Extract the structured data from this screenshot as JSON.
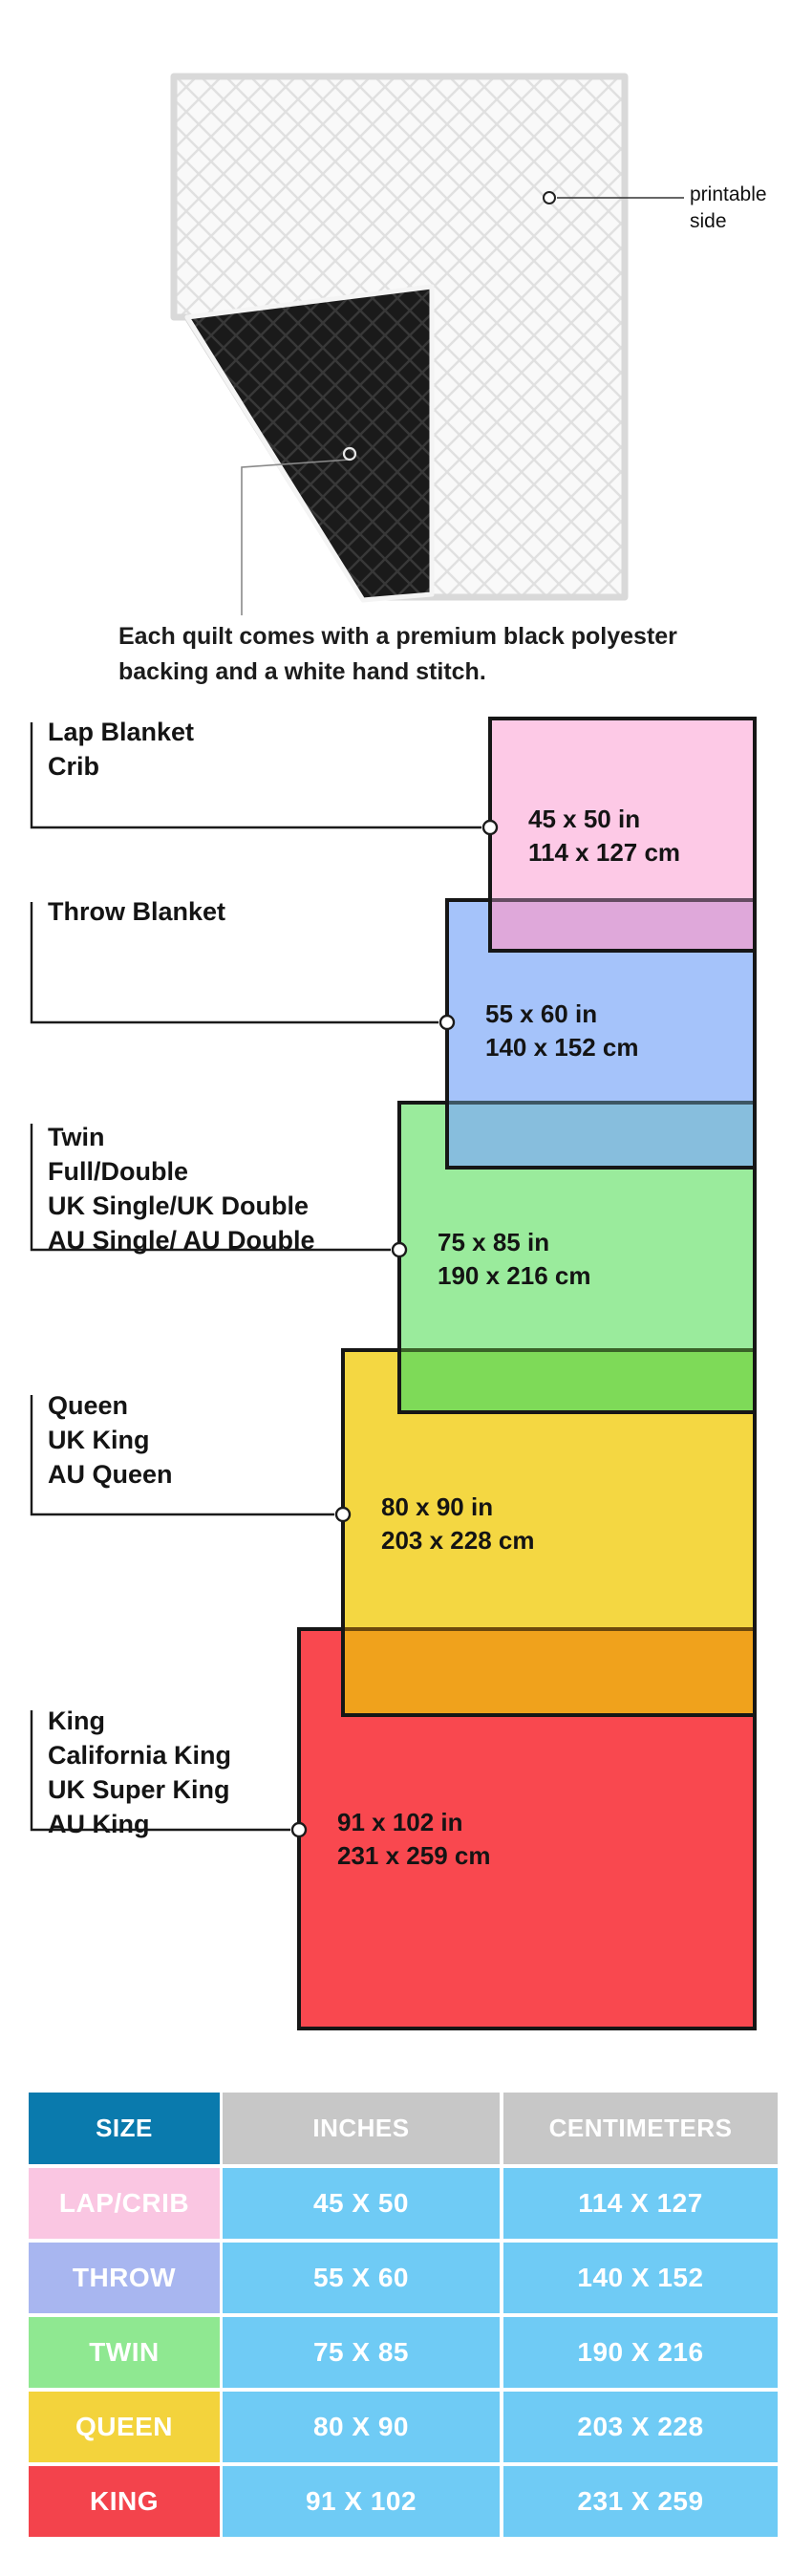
{
  "quilt": {
    "printable_label": "printable side",
    "caption_line1": "Each quilt comes with a premium black polyester",
    "caption_line2": "backing and a white hand stitch."
  },
  "sizes": [
    {
      "labels": [
        "Lap Blanket",
        "Crib"
      ],
      "inches": "45 x 50 in",
      "cm": "114 x 127 cm",
      "fill": "#fdc9e6",
      "overlap_fill": "#dfa8da"
    },
    {
      "labels": [
        "Throw Blanket"
      ],
      "inches": "55 x 60 in",
      "cm": "140 x 152 cm",
      "fill": "#a5c3fa",
      "overlap_fill": "#87bedd"
    },
    {
      "labels": [
        "Twin",
        "Full/Double",
        "UK Single/UK Double",
        "AU Single/ AU Double"
      ],
      "inches": "75 x 85 in",
      "cm": "190 x 216 cm",
      "fill": "#9aeb9c",
      "overlap_fill": "#7eda58"
    },
    {
      "labels": [
        "Queen",
        "UK King",
        "AU Queen"
      ],
      "inches": "80 x 90 in",
      "cm": "203 x 228 cm",
      "fill": "#f4d742",
      "overlap_fill": "#f0a21c"
    },
    {
      "labels": [
        "King",
        "California King",
        "UK Super King",
        "AU King"
      ],
      "inches": "91 x 102 in",
      "cm": "231 x 259 cm",
      "fill": "#f9484f",
      "overlap_fill": ""
    }
  ],
  "table": {
    "headers": {
      "size": "SIZE",
      "inches": "INCHES",
      "centimeters": "CENTIMETERS"
    },
    "colors": {
      "size_header_bg": "#0a7aad",
      "other_header_bg": "#c7c7c7",
      "value_bg": "#6fcbf5"
    },
    "rows": [
      {
        "size": "LAP/CRIB",
        "inches": "45 X 50",
        "cm": "114 X 127",
        "color": "#fac6e2"
      },
      {
        "size": "THROW",
        "inches": "55 X 60",
        "cm": "140 X 152",
        "color": "#a8b6f0"
      },
      {
        "size": "TWIN",
        "inches": "75 X 85",
        "cm": "190 X 216",
        "color": "#8fe891"
      },
      {
        "size": "QUEEN",
        "inches": "80 X 90",
        "cm": "203 X 228",
        "color": "#f3d33c"
      },
      {
        "size": "KING",
        "inches": "91 X 102",
        "cm": "231 X 259",
        "color": "#f3434c"
      }
    ]
  }
}
